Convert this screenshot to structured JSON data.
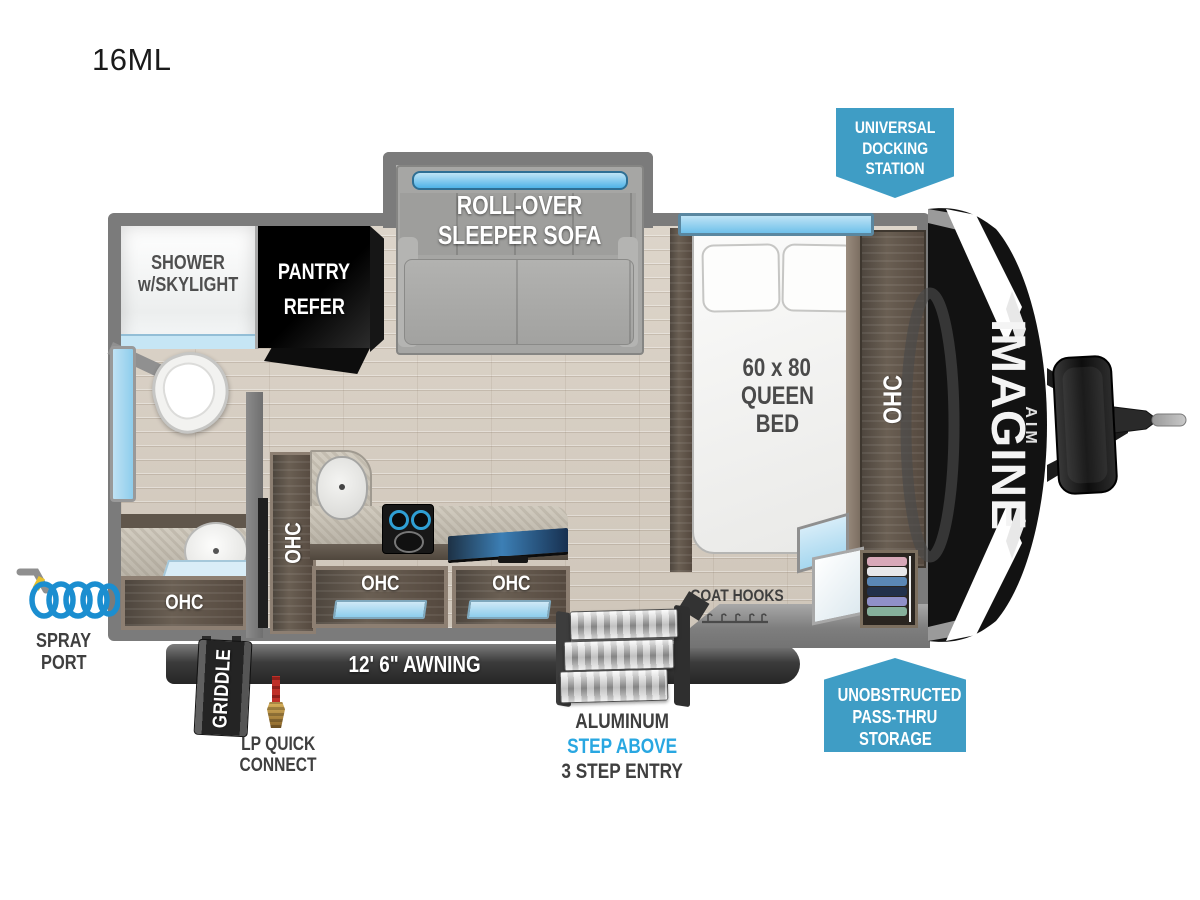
{
  "title": "16ML",
  "callouts": {
    "docking": {
      "line1": "UNIVERSAL",
      "line2": "DOCKING",
      "line3": "STATION"
    },
    "passthru": {
      "line1": "UNOBSTRUCTED",
      "line2": "PASS-THRU",
      "line3": "STORAGE"
    }
  },
  "labels": {
    "shower": {
      "line1": "SHOWER",
      "line2": "w/SKYLIGHT"
    },
    "pantry": {
      "line1": "PANTRY",
      "line2": "REFER"
    },
    "sofa": {
      "line1": "ROLL-OVER",
      "line2": "SLEEPER SOFA"
    },
    "bed": {
      "line1": "60 x 80",
      "line2": "QUEEN",
      "line3": "BED"
    },
    "ohc": "OHC",
    "coat_hooks": "COAT HOOKS"
  },
  "exterior": {
    "awning": "12' 6\" AWNING",
    "griddle": "GRIDDLE",
    "spray_port": {
      "line1": "SPRAY",
      "line2": "PORT"
    },
    "lp_connect": {
      "line1": "LP QUICK",
      "line2": "CONNECT"
    },
    "steps": {
      "line1": "ALUMINUM",
      "line2": "STEP ABOVE",
      "line3": "3 STEP ENTRY"
    },
    "brand": "IMAGINE",
    "brand_sub": "AIM"
  },
  "colors": {
    "callout_blue": "#3f9dc5",
    "step_above_blue": "#29a7e1",
    "wall_gray": "#7b7b7b",
    "label_dark": "#3f3f3f",
    "window_blue": "#7ec8ed",
    "floor_tan": "#d9d0c5"
  }
}
